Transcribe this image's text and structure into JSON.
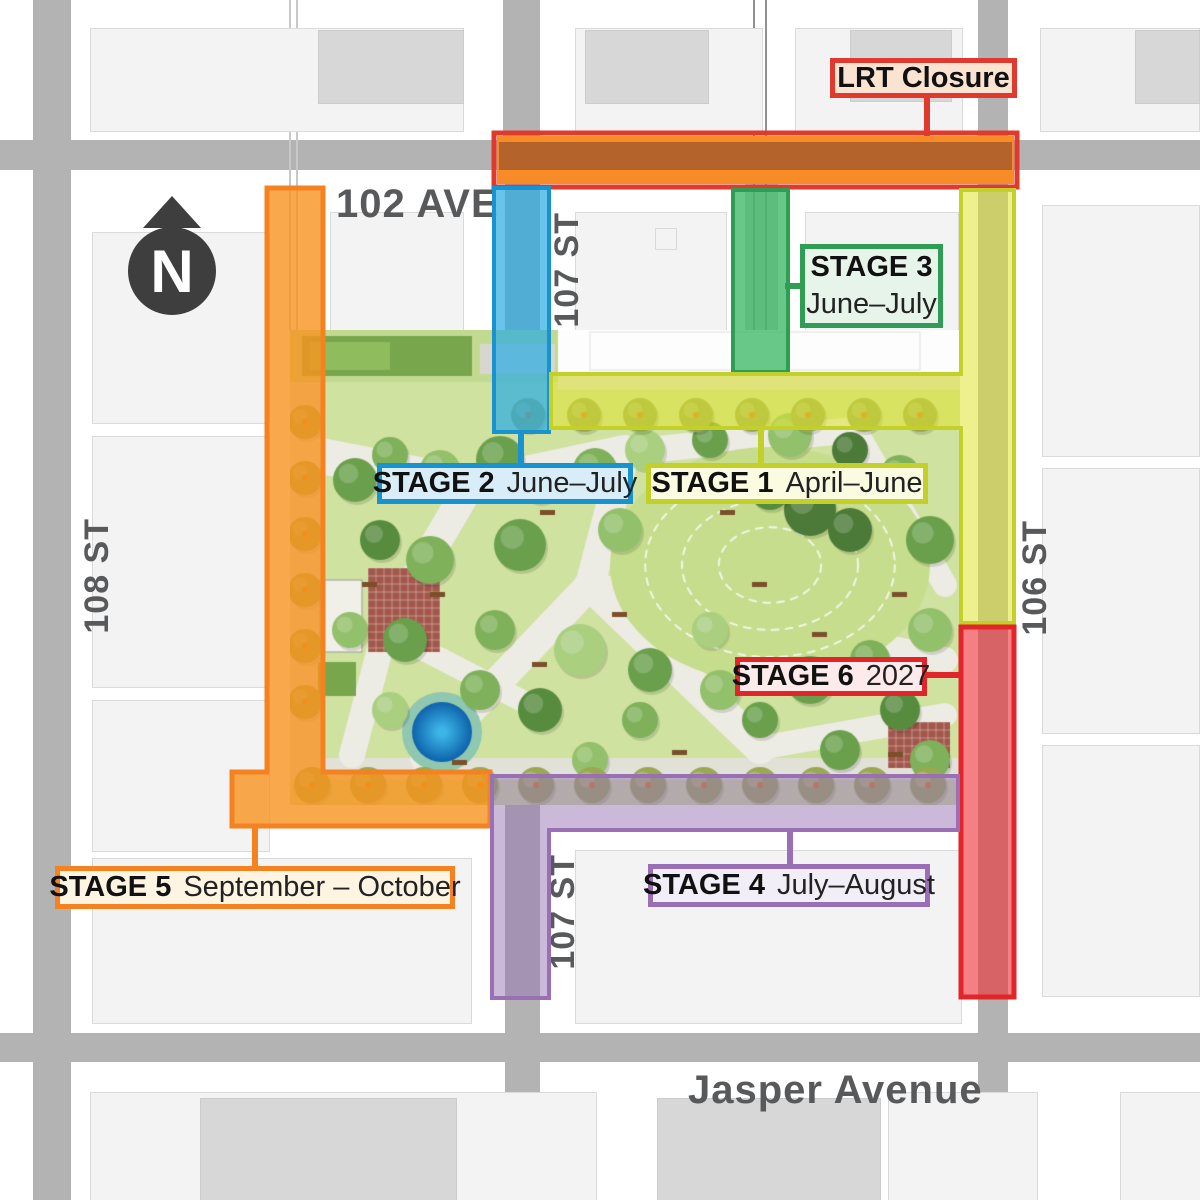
{
  "north_arrow": {
    "label": "N"
  },
  "streets": {
    "ave_102": "102 AVE",
    "st_107_north": "107 ST",
    "st_107_south": "107 ST",
    "st_108": "108 ST",
    "st_106": "106 ST",
    "jasper": "Jasper Avenue"
  },
  "callouts": {
    "lrt": {
      "title": "LRT Closure",
      "color": "#e0392e",
      "fill": "#fbe3d2"
    },
    "stage1": {
      "title": "STAGE 1",
      "dates": "April–June",
      "color": "#c3d02a",
      "fill": "#fafbe0"
    },
    "stage2": {
      "title": "STAGE 2",
      "dates": "June–July",
      "color": "#1893d0",
      "fill": "#d9edf9"
    },
    "stage3": {
      "title": "STAGE 3",
      "dates": "June–July",
      "color": "#2f9e54",
      "fill": "#e7f4ea"
    },
    "stage4": {
      "title": "STAGE 4",
      "dates": "July–August",
      "color": "#9a6fb5",
      "fill": "#f2eef8"
    },
    "stage5": {
      "title": "STAGE 5",
      "dates": "September – October",
      "color": "#f58220",
      "fill": "#fdf4e2"
    },
    "stage6": {
      "title": "STAGE 6",
      "dates": "2027",
      "color": "#e1252b",
      "fill": "#fdeaea"
    }
  }
}
